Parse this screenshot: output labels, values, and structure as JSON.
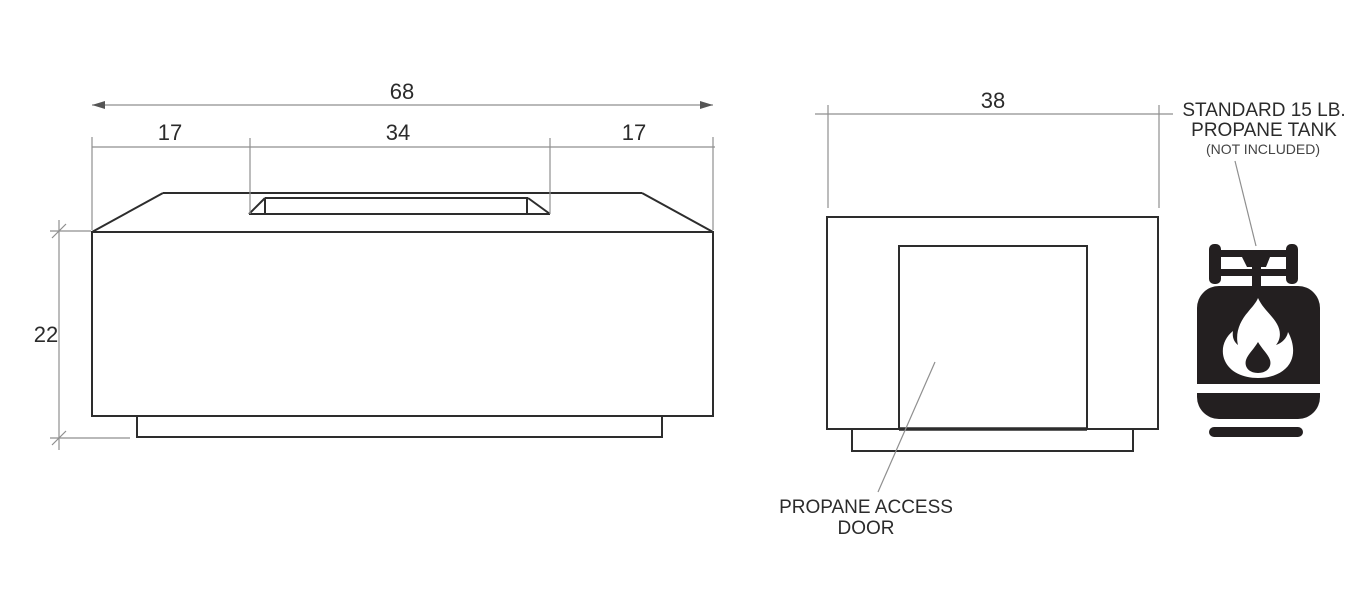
{
  "front_view": {
    "dim_overall": "68",
    "dim_left": "17",
    "dim_center": "34",
    "dim_right": "17",
    "dim_height": "22"
  },
  "side_view": {
    "dim_width": "38",
    "door_label_line1": "PROPANE ACCESS",
    "door_label_line2": "DOOR"
  },
  "tank": {
    "label_line1": "STANDARD 15 LB.",
    "label_line2": "PROPANE TANK",
    "note": "(NOT INCLUDED)"
  },
  "colors": {
    "background": "#ffffff",
    "outline": "#2d2d2d",
    "dimension": "#8f8f8f",
    "text": "#2b2b2b",
    "tank": "#231f20"
  }
}
